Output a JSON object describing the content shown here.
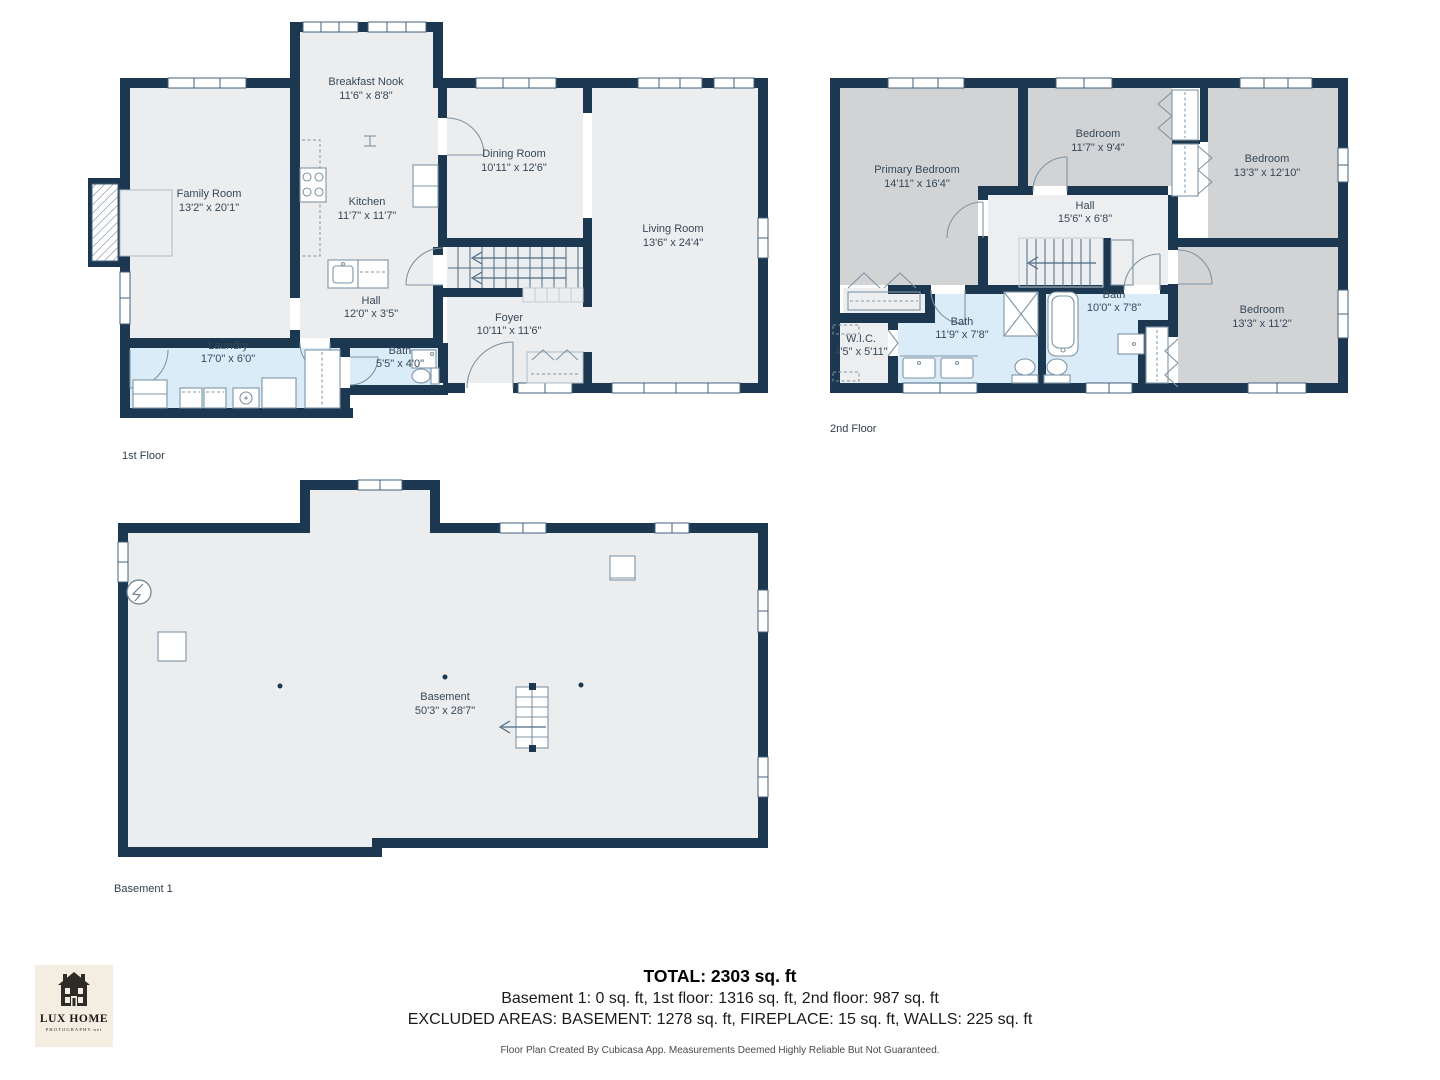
{
  "palette": {
    "wall_navy": "#1B3850",
    "floor_light": "#ECEDEE",
    "room_gray": "#D2D3D5",
    "wet_room_blue": "#D9ECF8",
    "label_text": "#36485A",
    "logo_background": "#F3EEE1"
  },
  "floors": {
    "first": {
      "label": "1st Floor",
      "rooms": {
        "family": {
          "name": "Family Room",
          "dims": "13'2\" x 20'1\""
        },
        "nook": {
          "name": "Breakfast Nook",
          "dims": "11'6\" x 8'8\""
        },
        "kitchen": {
          "name": "Kitchen",
          "dims": "11'7\" x 11'7\""
        },
        "dining": {
          "name": "Dining Room",
          "dims": "10'11\" x 12'6\""
        },
        "living": {
          "name": "Living Room",
          "dims": "13'6\" x 24'4\""
        },
        "hall": {
          "name": "Hall",
          "dims": "12'0\" x 3'5\""
        },
        "foyer": {
          "name": "Foyer",
          "dims": "10'11\" x 11'6\""
        },
        "laundry": {
          "name": "Laundry",
          "dims": "17'0\" x 6'0\""
        },
        "bath": {
          "name": "Bath",
          "dims": "5'5\" x 4'0\""
        }
      }
    },
    "second": {
      "label": "2nd Floor",
      "rooms": {
        "primary": {
          "name": "Primary Bedroom",
          "dims": "14'11\" x 16'4\""
        },
        "bedroom1": {
          "name": "Bedroom",
          "dims": "11'7\" x 9'4\""
        },
        "bedroom2": {
          "name": "Bedroom",
          "dims": "13'3\" x 12'10\""
        },
        "hall": {
          "name": "Hall",
          "dims": "15'6\" x 6'8\""
        },
        "bath1": {
          "name": "Bath",
          "dims": "11'9\" x 7'8\""
        },
        "bath2": {
          "name": "Bath",
          "dims": "10'0\" x 7'8\""
        },
        "wic": {
          "name": "W.I.C.",
          "dims": "4'5\" x 5'11\""
        },
        "bedroom3": {
          "name": "Bedroom",
          "dims": "13'3\" x 11'2\""
        }
      }
    },
    "basement": {
      "label": "Basement 1",
      "rooms": {
        "basement": {
          "name": "Basement",
          "dims": "50'3\" x 28'7\""
        }
      }
    }
  },
  "summary": {
    "total": "TOTAL: 2303 sq. ft",
    "floors_line": "Basement 1: 0 sq. ft, 1st floor: 1316 sq. ft, 2nd floor: 987 sq. ft",
    "excluded_line": "EXCLUDED AREAS: BASEMENT: 1278 sq. ft, FIREPLACE: 15 sq. ft, WALLS: 225 sq. ft",
    "disclaimer": "Floor Plan Created By Cubicasa App. Measurements Deemed Highly Reliable But Not Guaranteed."
  },
  "logo": {
    "title": "LUX HOME",
    "subtitle": "PHOTOGRAPHY.net"
  }
}
